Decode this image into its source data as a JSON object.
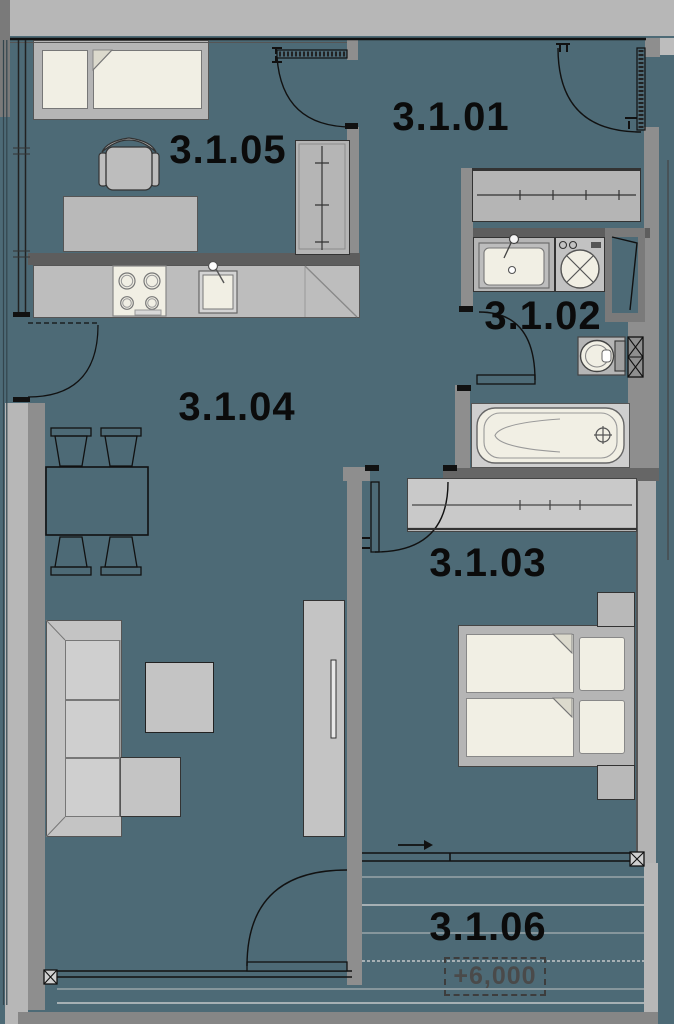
{
  "plan": {
    "title": "apartment-floor-plan",
    "rooms": [
      {
        "id": "hall",
        "label": "3.1.01"
      },
      {
        "id": "bathroom",
        "label": "3.1.02"
      },
      {
        "id": "bedroom",
        "label": "3.1.03"
      },
      {
        "id": "living-kitchen",
        "label": "3.1.04"
      },
      {
        "id": "study-bedroom",
        "label": "3.1.05"
      },
      {
        "id": "balcony",
        "label": "3.1.06"
      }
    ],
    "balcony": {
      "elevation_label": "+6,000"
    },
    "fixtures": [
      "single-bed",
      "office-chair",
      "desk",
      "tall-wardrobe",
      "kitchen-counter",
      "stove",
      "kitchen-sink",
      "corner-cabinet",
      "entry-door",
      "hall-closet",
      "vanity-sink",
      "washing-machine",
      "service-shaft",
      "toilet",
      "bathtub",
      "dining-table",
      "dining-chairs",
      "sofa",
      "ottoman",
      "coffee-table",
      "tv-unit",
      "double-bed",
      "nightstands",
      "bedroom-wardrobe",
      "sliding-window",
      "balcony-deck",
      "steel-columns"
    ],
    "colors": {
      "floor": "#4d6a76",
      "wall_light": "#b7b7b7",
      "wall_medium": "#8e8e8e",
      "wall_dark": "#5d5d5d",
      "furniture_gray": "#bfbfbf",
      "fixture_cream": "#f1efe4",
      "line": "#111111",
      "label_text": "#0b0b0b",
      "elevation_text": "#4a4a4a"
    }
  }
}
